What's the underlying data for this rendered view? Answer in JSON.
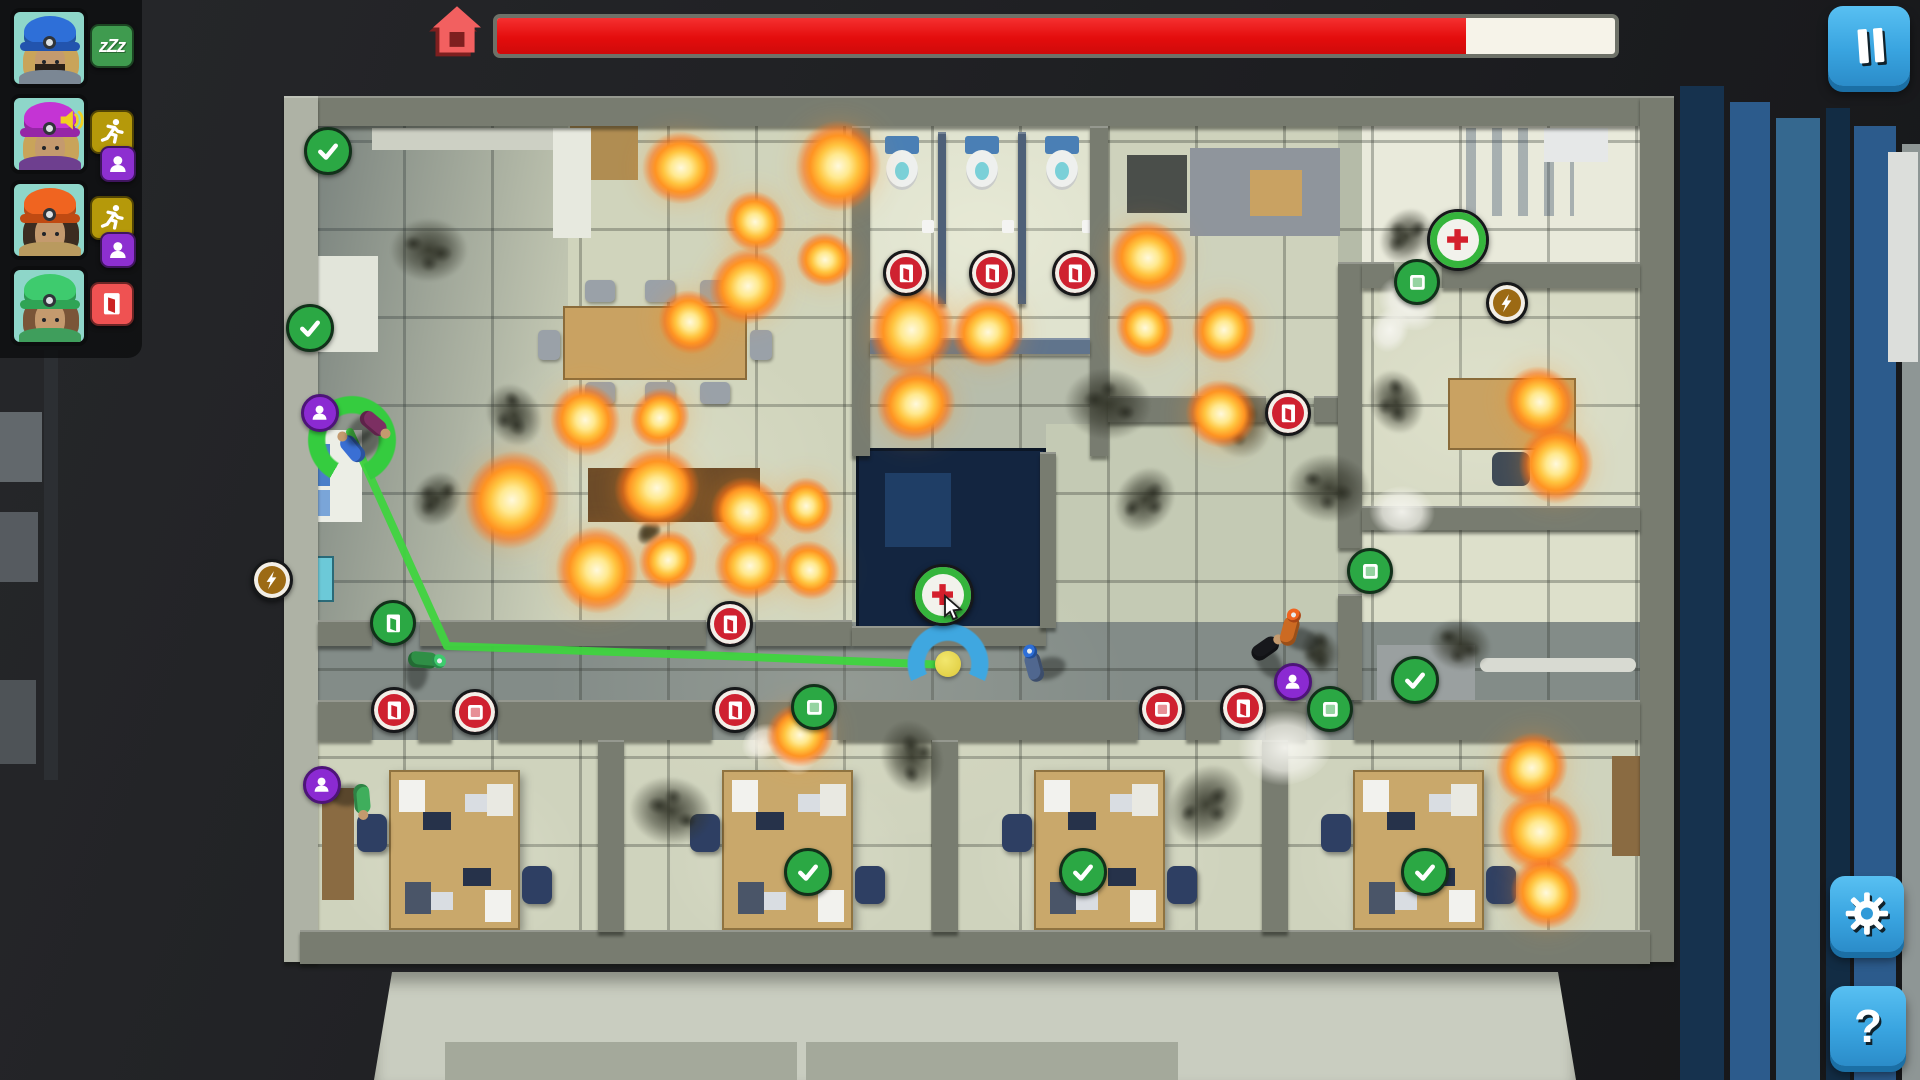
{
  "hud": {
    "badges": {
      "sleep": {
        "bg": "#3f9b4f",
        "label": "zZz"
      },
      "run": {
        "bg": "#b5990a"
      },
      "carry": {
        "bg": "#8d2fd0"
      },
      "door": {
        "bg": "#ef5252"
      }
    },
    "portraits": [
      {
        "id": "firefighter-blue",
        "helmet": "#2e6fd8",
        "helmet_dark": "#2254ae",
        "hair": "#c9a45a",
        "jacket": "#7b8794",
        "beard": "#2a2018",
        "speaker": false,
        "statuses": [
          "sleep"
        ]
      },
      {
        "id": "firefighter-magenta",
        "helmet": "#c434d4",
        "helmet_dark": "#9626a6",
        "hair": "#c9a45a",
        "jacket": "#6e3f8f",
        "beard": "",
        "speaker": true,
        "statuses": [
          "run",
          "carry"
        ]
      },
      {
        "id": "firefighter-orange",
        "helmet": "#f06420",
        "helmet_dark": "#c04a12",
        "hair": "#3c2c20",
        "jacket": "#b99a5f",
        "beard": "",
        "speaker": false,
        "statuses": [
          "run",
          "carry"
        ]
      },
      {
        "id": "firefighter-green",
        "helmet": "#3ecb6e",
        "helmet_dark": "#2fa455",
        "hair": "#7a5538",
        "jacket": "#3f9e5c",
        "beard": "",
        "speaker": false,
        "statuses": [
          "door"
        ]
      }
    ],
    "topbar": {
      "progress_fraction": 0.867,
      "bar_fill": "#e90f0f",
      "bar_bg": "#f6f3e9"
    },
    "buttons": {
      "help_label": "?"
    }
  },
  "map": {
    "markers": [
      {
        "t": "door",
        "c": "red",
        "x": 906,
        "y": 273
      },
      {
        "t": "door",
        "c": "red",
        "x": 992,
        "y": 273
      },
      {
        "t": "door",
        "c": "red",
        "x": 1075,
        "y": 273
      },
      {
        "t": "door",
        "c": "red",
        "x": 1288,
        "y": 413
      },
      {
        "t": "door",
        "c": "red",
        "x": 394,
        "y": 710
      },
      {
        "t": "door",
        "c": "red",
        "x": 730,
        "y": 624
      },
      {
        "t": "door",
        "c": "red",
        "x": 735,
        "y": 710
      },
      {
        "t": "door",
        "c": "red",
        "x": 1243,
        "y": 708
      },
      {
        "t": "door",
        "c": "green",
        "x": 393,
        "y": 623
      },
      {
        "t": "window",
        "c": "red",
        "x": 475,
        "y": 712
      },
      {
        "t": "window",
        "c": "red",
        "x": 1162,
        "y": 709
      },
      {
        "t": "window",
        "c": "green",
        "x": 814,
        "y": 707
      },
      {
        "t": "window",
        "c": "green",
        "x": 1330,
        "y": 709
      },
      {
        "t": "window",
        "c": "green",
        "x": 1417,
        "y": 282
      },
      {
        "t": "window",
        "c": "green",
        "x": 1370,
        "y": 571
      },
      {
        "t": "check",
        "c": "green",
        "x": 328,
        "y": 151
      },
      {
        "t": "check",
        "c": "green",
        "x": 310,
        "y": 328
      },
      {
        "t": "check",
        "c": "green",
        "x": 1415,
        "y": 680
      },
      {
        "t": "check",
        "c": "green",
        "x": 808,
        "y": 872
      },
      {
        "t": "check",
        "c": "green",
        "x": 1083,
        "y": 872
      },
      {
        "t": "check",
        "c": "green",
        "x": 1425,
        "y": 872
      },
      {
        "t": "med",
        "c": "med",
        "x": 943,
        "y": 595
      },
      {
        "t": "med",
        "c": "med",
        "x": 1458,
        "y": 240
      },
      {
        "t": "bolt",
        "c": "gold",
        "x": 272,
        "y": 580
      },
      {
        "t": "bolt",
        "c": "gold",
        "x": 1507,
        "y": 303
      }
    ],
    "victims": [
      [
        320,
        413
      ],
      [
        322,
        785
      ],
      [
        1293,
        682
      ]
    ],
    "fires": [
      [
        681,
        168,
        78
      ],
      [
        755,
        222,
        64
      ],
      [
        838,
        166,
        92
      ],
      [
        748,
        286,
        80
      ],
      [
        825,
        260,
        58
      ],
      [
        690,
        322,
        66
      ],
      [
        912,
        330,
        92
      ],
      [
        988,
        332,
        74
      ],
      [
        1148,
        258,
        80
      ],
      [
        1145,
        328,
        62
      ],
      [
        1224,
        330,
        68
      ],
      [
        916,
        404,
        80
      ],
      [
        1221,
        414,
        72
      ],
      [
        585,
        420,
        74
      ],
      [
        512,
        500,
        100
      ],
      [
        657,
        488,
        86
      ],
      [
        747,
        512,
        74
      ],
      [
        597,
        570,
        88
      ],
      [
        668,
        560,
        62
      ],
      [
        750,
        566,
        72
      ],
      [
        810,
        570,
        62
      ],
      [
        806,
        506,
        58
      ],
      [
        660,
        418,
        62
      ],
      [
        800,
        735,
        68
      ],
      [
        1540,
        402,
        74
      ],
      [
        1556,
        464,
        80
      ],
      [
        1532,
        768,
        74
      ],
      [
        1540,
        832,
        86
      ],
      [
        1546,
        893,
        74
      ]
    ],
    "smokes": [
      [
        429,
        250,
        78
      ],
      [
        514,
        415,
        66
      ],
      [
        437,
        499,
        58
      ],
      [
        1108,
        404,
        88
      ],
      [
        1237,
        420,
        80
      ],
      [
        1145,
        500,
        70
      ],
      [
        1329,
        488,
        84
      ],
      [
        1396,
        402,
        66
      ],
      [
        1406,
        236,
        60
      ],
      [
        671,
        811,
        84
      ],
      [
        912,
        757,
        76
      ],
      [
        1206,
        804,
        86
      ],
      [
        1460,
        645,
        64
      ],
      [
        1320,
        652,
        48
      ],
      [
        649,
        533,
        26
      ]
    ],
    "debris": [
      [
        1285,
        748,
        95
      ],
      [
        1408,
        304,
        64
      ],
      [
        795,
        748,
        56
      ],
      [
        1390,
        330,
        46
      ],
      [
        762,
        742,
        44
      ],
      [
        1402,
        512,
        66
      ]
    ],
    "path": {
      "color": "#3fd43f",
      "points": [
        [
          350,
          432
        ],
        [
          447,
          646
        ],
        [
          700,
          655
        ],
        [
          948,
          665
        ]
      ]
    },
    "action_ring": {
      "x": 352,
      "y": 440,
      "d": 92
    },
    "move_target": {
      "x": 948,
      "y": 664,
      "arc_d": 86,
      "dot_d": 26
    },
    "cursor": {
      "x": 941,
      "y": 594
    },
    "characters": [
      {
        "x": 352,
        "y": 448,
        "rot": -40,
        "jacket": "#3a6fd4",
        "helmet": ""
      },
      {
        "x": 374,
        "y": 424,
        "rot": 130,
        "jacket": "#7c2f62",
        "helmet": ""
      },
      {
        "x": 424,
        "y": 660,
        "rot": 95,
        "jacket": "#2f8f46",
        "helmet": "#3ecb6e"
      },
      {
        "x": 1034,
        "y": 666,
        "rot": -15,
        "jacket": "#50678f",
        "helmet": "#2e6fd8"
      },
      {
        "x": 1266,
        "y": 648,
        "rot": 55,
        "jacket": "#17181c",
        "helmet": ""
      },
      {
        "x": 1290,
        "y": 630,
        "rot": 15,
        "jacket": "#cc6a22",
        "helmet": "#f06420"
      },
      {
        "x": 362,
        "y": 800,
        "rot": 175,
        "jacket": "#3fae5c",
        "helmet": ""
      }
    ]
  }
}
